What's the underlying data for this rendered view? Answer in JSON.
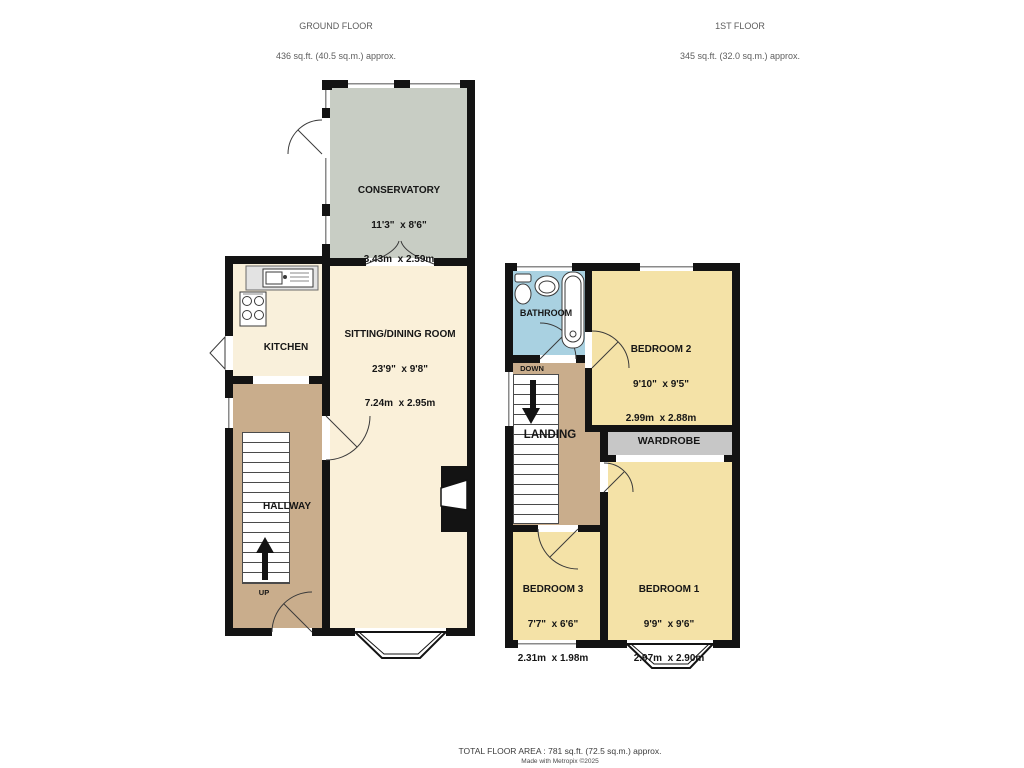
{
  "floors": {
    "ground": {
      "title": "GROUND FLOOR",
      "area": "436 sq.ft. (40.5 sq.m.) approx.",
      "stairs_label": "UP",
      "rooms": {
        "conservatory": {
          "name": "CONSERVATORY",
          "imperial": "11'3\"  x 8'6\"",
          "metric": "3.43m  x 2.59m"
        },
        "sitting_dining": {
          "name": "SITTING/DINING ROOM",
          "imperial": "23'9\"  x 9'8\"",
          "metric": "7.24m  x 2.95m"
        },
        "kitchen": {
          "name": "KITCHEN"
        },
        "hallway": {
          "name": "HALLWAY"
        }
      }
    },
    "first": {
      "title": "1ST FLOOR",
      "area": "345 sq.ft. (32.0 sq.m.) approx.",
      "stairs_label": "DOWN",
      "rooms": {
        "bathroom": {
          "name": "BATHROOM"
        },
        "bedroom2": {
          "name": "BEDROOM 2",
          "imperial": "9'10\"  x 9'5\"",
          "metric": "2.99m  x 2.88m"
        },
        "landing": {
          "name": "LANDING"
        },
        "wardrobe": {
          "name": "WARDROBE"
        },
        "bedroom3": {
          "name": "BEDROOM 3",
          "imperial": "7'7\"  x 6'6\"",
          "metric": "2.31m  x 1.98m"
        },
        "bedroom1": {
          "name": "BEDROOM 1",
          "imperial": "9'9\"  x 9'6\"",
          "metric": "2.97m  x 2.90m"
        }
      }
    }
  },
  "footer": {
    "total_area": "TOTAL FLOOR AREA : 781 sq.ft. (72.5 sq.m.) approx.",
    "credit": "Made with Metropix ©2025"
  },
  "colors": {
    "wall": "#131313",
    "conservatory": "#c8cdc4",
    "living_cream": "#faf0d9",
    "hall_landing_tan": "#c9ad8c",
    "bedroom_yellow": "#f4e2a7",
    "bathroom_blue": "#a9d1e1",
    "wardrobe_grey": "#c7c7c7"
  }
}
